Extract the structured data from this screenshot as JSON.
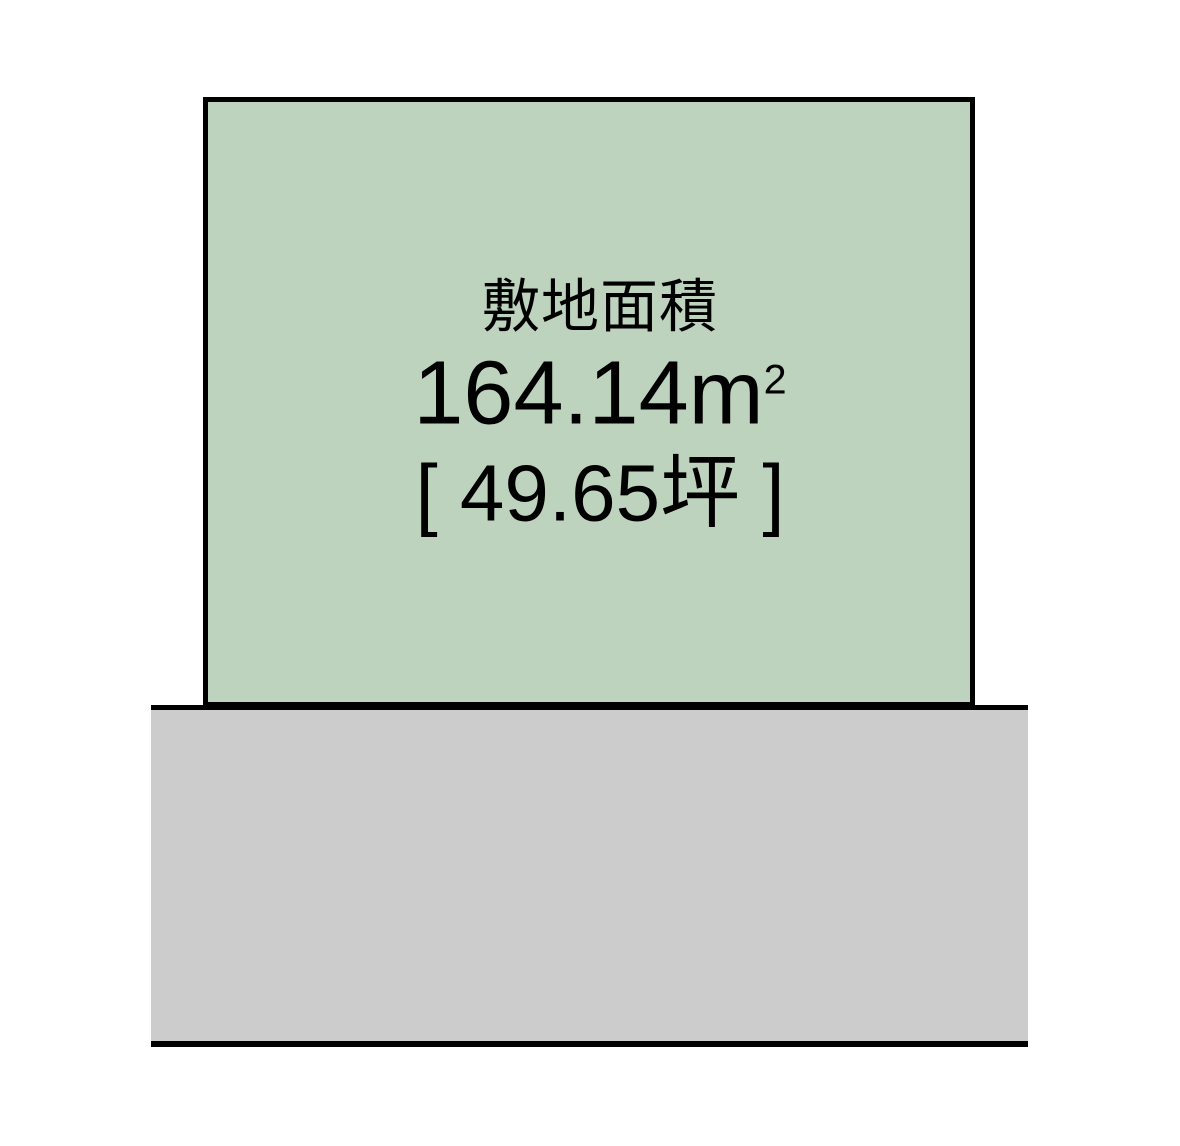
{
  "diagram": {
    "title": "land-plot-site-plan",
    "plot": {
      "area_label": "敷地面積",
      "area_value": "164.14",
      "area_unit_base": "m",
      "area_unit_exponent": "2",
      "tsubo_text": "[ 49.65坪 ]"
    },
    "road": {}
  },
  "colors": {
    "plot-fill": "#bed3bd",
    "road-fill": "#cccccc",
    "line": "#000000",
    "text": "#000000",
    "background": "#ffffff"
  }
}
